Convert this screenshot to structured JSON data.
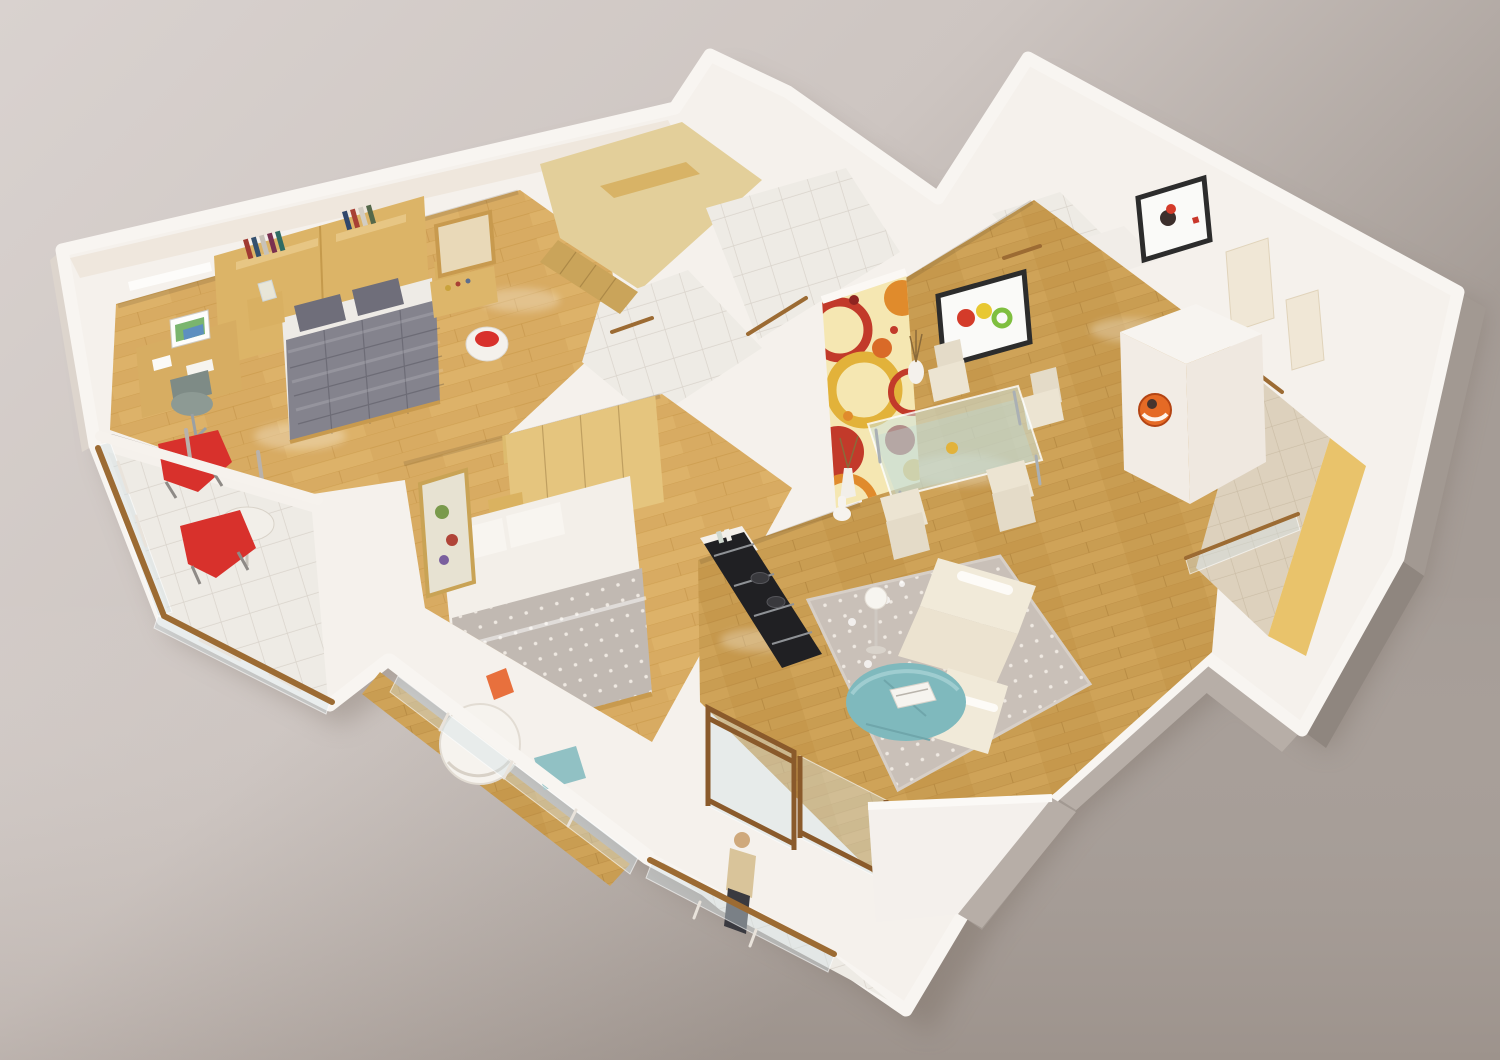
{
  "meta": {
    "description": "3D isometric cutaway render of an apartment floor plan on a neutral studio backdrop, no visible text",
    "projection": "isometric perspective, cut walls with white tops"
  },
  "palette": {
    "bg_top": "#d9d2cf",
    "bg_mid": "#cdc5c1",
    "bg_right": "#a59c96",
    "bg_bottom": "#c3bab6",
    "ground_shadow": "#6f6257",
    "slab": "#f5f1ec",
    "wall_top": "#f8f5f1",
    "wall_inner": "#efe7dd",
    "wall_gray_dark": "#8f867f",
    "wall_gray": "#a29992",
    "wall_gray_light": "#b7aea7",
    "wood_living": "#c99d52",
    "wood_living_dark": "#b8873f",
    "wood_bedroom": "#d8ab62",
    "wood_bedroom_dark": "#c3913f",
    "closet_floor": "#e3cf9a",
    "closet_front": "#caa45a",
    "tile_white": "#eeebe5",
    "tile_grout": "#d9d3cb",
    "tile_beige": "#ddd1bd",
    "tile_beige_grout": "#cbbda6",
    "stripe_yellow": "#e9c36b",
    "wood_trim": "#9c6b33",
    "headboard_wood": "#dcb467",
    "wardrobe_wood": "#e5c57e",
    "bed1_duvet": "#84838d",
    "bed1_pillow": "#6f6e7a",
    "bed1_sheet": "#eeebe6",
    "bed2_white": "#f3efe9",
    "bed2_blanket": "#c1b9b2",
    "red_accent": "#d8312c",
    "teal_accent": "#7fb9bd",
    "orange_accent": "#e8703d",
    "sofa_cream": "#f1ead9",
    "rug": "#c9c0b8",
    "rug_dot": "#efe9e2",
    "art_bg": "#f5e7b2",
    "art_red": "#c23a2a",
    "art_orange": "#e08b2c",
    "art_yellow": "#e2b23a",
    "art_dark_red": "#8e2420",
    "appliance_black": "#202023",
    "frame_dark": "#2c2c2c",
    "picture_mat": "#fafaf8",
    "fruit_red": "#d43b2a",
    "fruit_yellow": "#e8c832",
    "fruit_green": "#7fbf3f",
    "clock_orange": "#e56a25",
    "chair_cream": "#ece4d2",
    "office_chair": "#8d9a94",
    "cabinet_white": "#f2ece5",
    "person_skin": "#cfa97c",
    "person_top": "#d9c49a",
    "person_bottom": "#3a3a40"
  },
  "scene": {
    "type": "3d-floor-plan-render",
    "rooms": [
      {
        "id": "master-bedroom",
        "floor": "light wood",
        "items": [
          "double bed with gray damask duvet and two gray pillows",
          "tan headboard wall panel",
          "wall shelves with books",
          "desk with monitor and papers",
          "swivel office chair",
          "red lounge chair",
          "white drum stool with red top",
          "dressing table with mirror",
          "glass cube bedside lamp",
          "wall light strip"
        ]
      },
      {
        "id": "bedroom-2",
        "floor": "light wood",
        "items": [
          "double bed with white linen and dotted gray throw",
          "light wood wardrobe run with tall corner unit",
          "bedside cabinet",
          "leaning framed artwork",
          "white ball chair",
          "orange cushion",
          "teal chair"
        ]
      },
      {
        "id": "walk-in-closet",
        "floor": "tan",
        "items": [
          "built-in wardrobe fronts"
        ]
      },
      {
        "id": "bathroom-top",
        "floor": "white tile",
        "items": [
          "wood threshold"
        ]
      },
      {
        "id": "bathroom-right",
        "floor": "white tile",
        "items": [
          "wood threshold"
        ]
      },
      {
        "id": "inner-hallway",
        "floor": "white tile",
        "items": [
          "wood thresholds"
        ]
      },
      {
        "id": "dining-area",
        "floor": "wood planks",
        "items": [
          "glass dining table with chrome legs",
          "four cream high-back chairs",
          "white vases with twigs",
          "framed fruit still-life",
          "circle-pattern accent wall"
        ]
      },
      {
        "id": "living-area",
        "floor": "wood planks",
        "items": [
          "cream sofa with chaise",
          "round teal ottoman table with magazines",
          "polka-dot area rug",
          "globe floor lamp",
          "scattered glassware"
        ]
      },
      {
        "id": "kitchen",
        "floor": "wood planks",
        "items": [
          "dark counter run with cooktop and appliances",
          "white jar"
        ]
      },
      {
        "id": "entry-corridor",
        "floor": "beige tile with yellow accent stripe",
        "items": [
          "tall white cabinet with orange wall clock",
          "framed red-bird artwork",
          "cream interior doors",
          "glass partition with wood cap"
        ]
      },
      {
        "id": "balcony-master",
        "floor": "white tile",
        "items": [
          "red chair",
          "round white table",
          "glass railing with wood cap"
        ]
      },
      {
        "id": "balcony-bedroom-2",
        "floor": "wood strip",
        "items": [
          "white-framed glass railing"
        ]
      },
      {
        "id": "balcony-kitchen",
        "floor": "white tile",
        "items": [
          "standing person figure",
          "wood-framed sliding glass doors",
          "glass railing with wood cap"
        ]
      }
    ]
  }
}
